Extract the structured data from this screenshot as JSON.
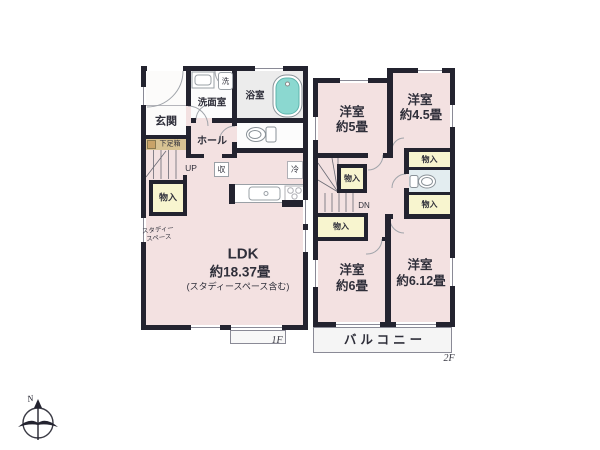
{
  "compass": {
    "north": "N"
  },
  "f1": {
    "floor_label": "1F",
    "entrance": "玄関",
    "shoe_cabinet": "下足箱",
    "washroom": "洗面室",
    "laundry": "洗",
    "bathroom": "浴室",
    "hall": "ホール",
    "stairs_up": "UP",
    "storage": "収",
    "fridge": "冷",
    "closet": "物入",
    "study_space_line1": "スタディー",
    "study_space_line2": "スペース",
    "ldk_name": "LDK",
    "ldk_size": "約18.37畳",
    "ldk_note": "(スタディースペース含む)"
  },
  "f2": {
    "floor_label": "2F",
    "bedroom_a_name": "洋室",
    "bedroom_a_size": "約5畳",
    "bedroom_b_name": "洋室",
    "bedroom_b_size": "約4.5畳",
    "bedroom_c_name": "洋室",
    "bedroom_c_size": "約6畳",
    "bedroom_d_name": "洋室",
    "bedroom_d_size": "約6.12畳",
    "closet": "物入",
    "stairs_down": "DN",
    "balcony": "バルコニー"
  },
  "colors": {
    "wall": "#23232f",
    "room_pink": "#f3e1e1",
    "closet_yellow": "#f8f5cf",
    "bathtub_teal": "#8bd8d0",
    "shoe_cabinet_tan": "#d8c393",
    "toilet_room_blue": "#e3edf0",
    "balcony_gray": "#f5f5f5"
  }
}
